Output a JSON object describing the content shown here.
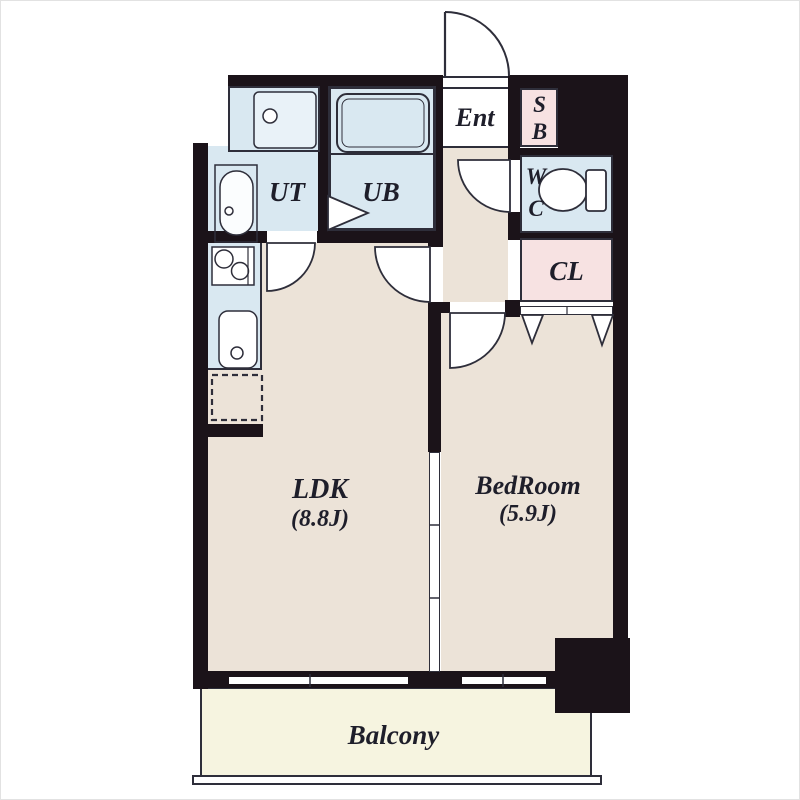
{
  "title": "1LDK apartment floor plan",
  "rooms": {
    "ldk": {
      "label": "LDK",
      "size": "(8.8J)"
    },
    "bedroom": {
      "label": "BedRoom",
      "size": "(5.9J)"
    },
    "balcony": {
      "label": "Balcony"
    },
    "entrance": {
      "label": "Ent"
    },
    "shoe_box": {
      "line1": "S",
      "line2": "B"
    },
    "wc": {
      "line1": "W",
      "line2": "C"
    },
    "closet": {
      "label": "CL"
    },
    "utility": {
      "label": "UT"
    },
    "unit_bath": {
      "label": "UB"
    }
  },
  "fixtures": [
    "entrance-door-arc",
    "bathtub",
    "washing-machine-pan",
    "vanity-sink",
    "kitchen-stove",
    "kitchen-sink",
    "refrigerator-space",
    "toilet",
    "bath-door-arrow",
    "closet-hanger-marks",
    "sliding-partition",
    "windows"
  ],
  "colors": {
    "wall": "#1b1319",
    "line": "#2e2e3a",
    "floor": "#ece3d8",
    "water": "#d9e8f1",
    "pink": "#f7e2e2",
    "balcony_fill": "#f6f4e0",
    "text": "#1e1e2a",
    "white": "#ffffff"
  }
}
